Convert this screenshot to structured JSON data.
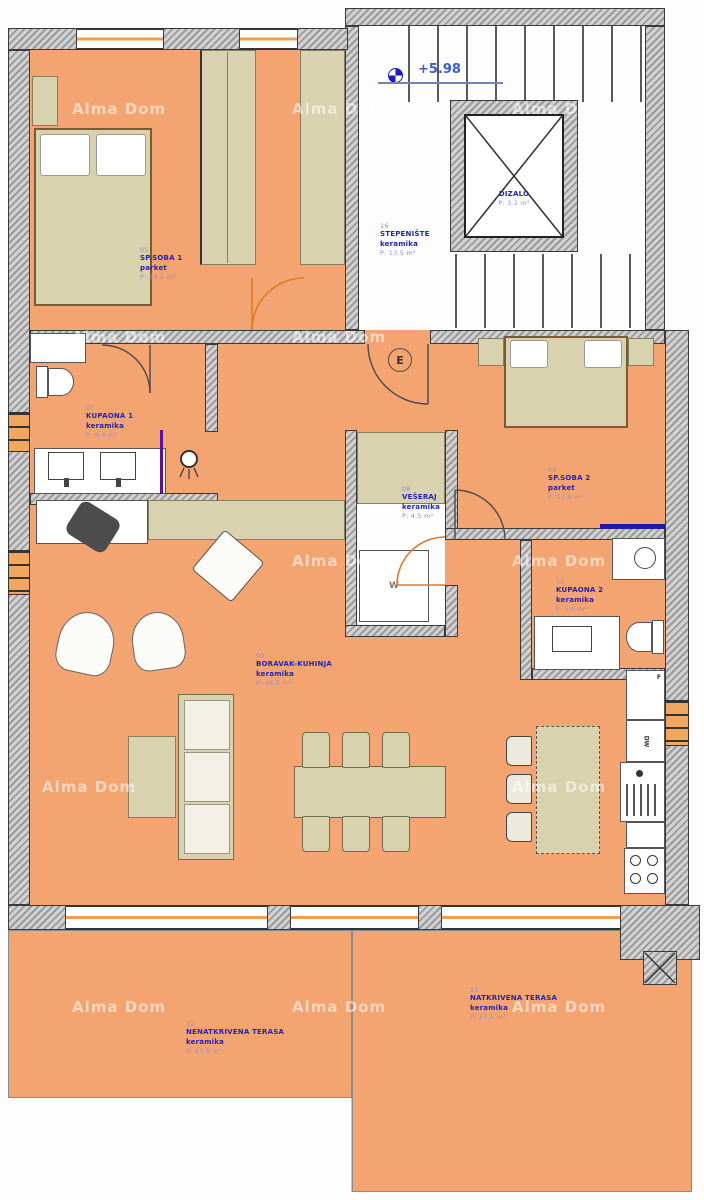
{
  "plan": {
    "watermark": "Alma Dom",
    "elevation": "+5.98",
    "colors": {
      "floor_orange": "#f4a470",
      "furniture_tan": "#d8d2ae",
      "label_blue": "#2323b8",
      "label_light": "#958dd0",
      "window_orange": "#ef9f4d",
      "wall_gray": "#9a9a9a",
      "glass_blue_wall": "#1d1daa",
      "shower_glass_purple": "#5a10a8"
    }
  },
  "rooms": {
    "stairs": {
      "num": "16",
      "name": "STEPENIŠTE",
      "floor": "keramika",
      "area": "P: 13.5 m²"
    },
    "elevator": {
      "name": "DIZALO",
      "area": "P: 3.2 m²"
    },
    "bedroom1": {
      "num": "05",
      "name": "SP.SOBA 1",
      "floor": "parket",
      "area": "P: 24.1 m²"
    },
    "bath1": {
      "num": "07",
      "name": "KUPAONA 1",
      "floor": "keramika",
      "area": "P: 6.4 m²"
    },
    "laundry": {
      "num": "08",
      "name": "VEŠERAJ",
      "floor": "keramika",
      "area": "P: 4.5 m²"
    },
    "bedroom2": {
      "num": "06",
      "name": "SP.SOBA 2",
      "floor": "parket",
      "area": "P: 11.0 m²"
    },
    "bath2": {
      "num": "10",
      "name": "KUPAONA 2",
      "floor": "keramika",
      "area": "P: 5.0 m²"
    },
    "living": {
      "num": "09",
      "name": "BORAVAK-KUHINJA",
      "floor": "keramika",
      "area": "P: 38.8 m²"
    },
    "terrace_covered": {
      "num": "11",
      "name": "NATKRIVENA TERASA",
      "floor": "keramika",
      "area": "P: 27.1 m²"
    },
    "terrace_open": {
      "num": "12",
      "name": "NENATKRIVENA TERASA",
      "floor": "keramika",
      "area": "P: 13.0 m²"
    }
  },
  "symbols": {
    "electric_meter": "E",
    "washing_machine": "W",
    "fridge": "F",
    "dishwasher": "DW"
  }
}
